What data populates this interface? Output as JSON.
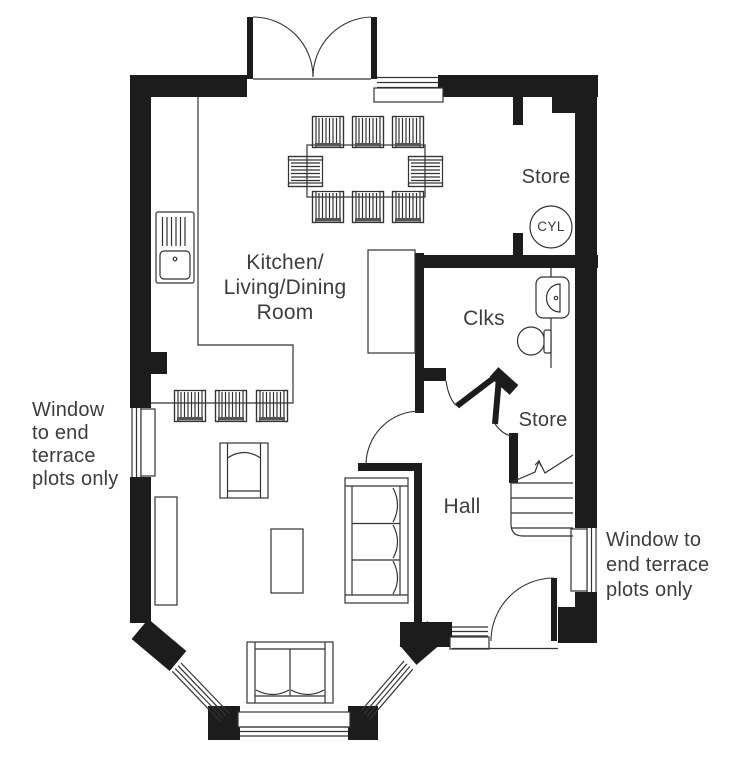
{
  "rooms": {
    "kitchen_living_dining": {
      "lines": [
        "Kitchen/",
        "Living/Dining",
        "Room"
      ]
    },
    "clks": {
      "label": "Clks"
    },
    "hall": {
      "label": "Hall"
    },
    "store_top": {
      "label": "Store"
    },
    "store_under_stairs": {
      "label": "Store"
    },
    "cylinder": {
      "label": "CYL"
    }
  },
  "annotations": {
    "left_window_note": {
      "lines": [
        "Window",
        "to end",
        "terrace",
        "plots only"
      ]
    },
    "right_window_note": {
      "lines": [
        "Window to",
        "end terrace",
        "plots only"
      ]
    }
  },
  "colors": {
    "wall": "#1c1c1c",
    "line": "#333333",
    "text": "#3d3d3d",
    "background": "#ffffff"
  }
}
